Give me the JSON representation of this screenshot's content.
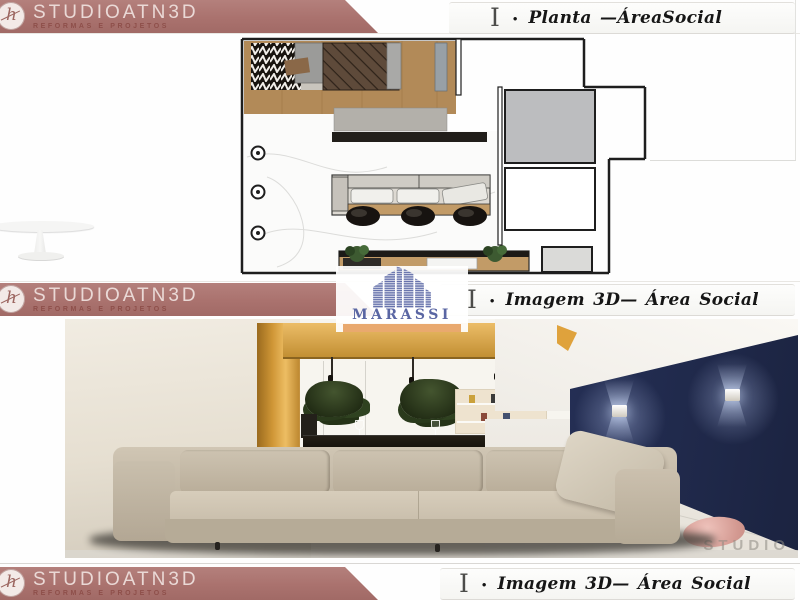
{
  "brand": {
    "name": "STUDIOATN3D",
    "tagline": "REFORMAS E PROJETOS",
    "monogram": "h",
    "banner_color": "#ab7370",
    "banner_text_color": "#ead9d6"
  },
  "sections": {
    "planta": {
      "marker": "I",
      "bullet": "•",
      "title": "Planta —ÁreaSocial"
    },
    "imagem": {
      "marker": "I",
      "bullet": "•",
      "title": "Imagem 3D— Área Social"
    },
    "imagem_footer": {
      "marker": "I",
      "bullet": "•",
      "title": "Imagem 3D— Área Social"
    }
  },
  "marassi": {
    "name": "MARASSI",
    "icon": "buildings-icon",
    "text_color": "#5a66a3",
    "underline_color": "#e9a96e"
  },
  "render": {
    "watermark": "STUDIO",
    "accent_wall_color": "#2c3760",
    "rug_color": "#d49a92",
    "sofa_color": "#c6bcaa"
  }
}
